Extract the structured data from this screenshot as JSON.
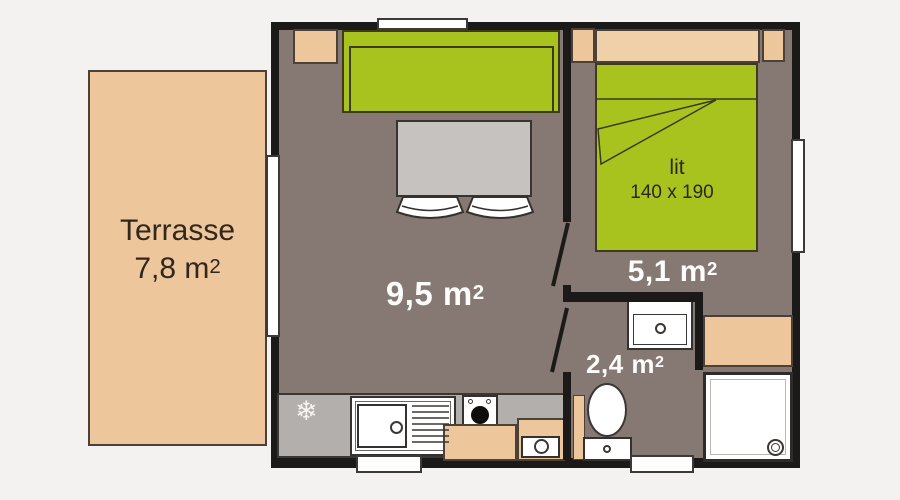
{
  "plan": {
    "type": "floor-plan",
    "description": "Mobile home floor plan with terrace, living room, bedroom and bathroom"
  },
  "rooms": {
    "terrace": {
      "name": "Terrasse",
      "area": "7,8 m",
      "sup": "2"
    },
    "living": {
      "area": "9,5 m",
      "sup": "2"
    },
    "bedroom": {
      "area": "5,1 m",
      "sup": "2"
    },
    "bathroom": {
      "area": "2,4 m",
      "sup": "2"
    }
  },
  "bed": {
    "label": "lit",
    "dimensions": "140 x 190"
  },
  "icons": {
    "fridge_snowflake": "❄"
  },
  "colors": {
    "background": "#f3f2f0",
    "wall": "#1c1a18",
    "floor": "#867973",
    "terrace_beige": "#edc69b",
    "headboard_beige": "#f0d0a8",
    "furniture_green": "#a9c31e",
    "table_gray": "#c6c2bf",
    "counter_gray": "#b3afac",
    "fixture_white": "#ffffff",
    "label_white": "#fdfdfb",
    "label_dark": "#30271d"
  }
}
